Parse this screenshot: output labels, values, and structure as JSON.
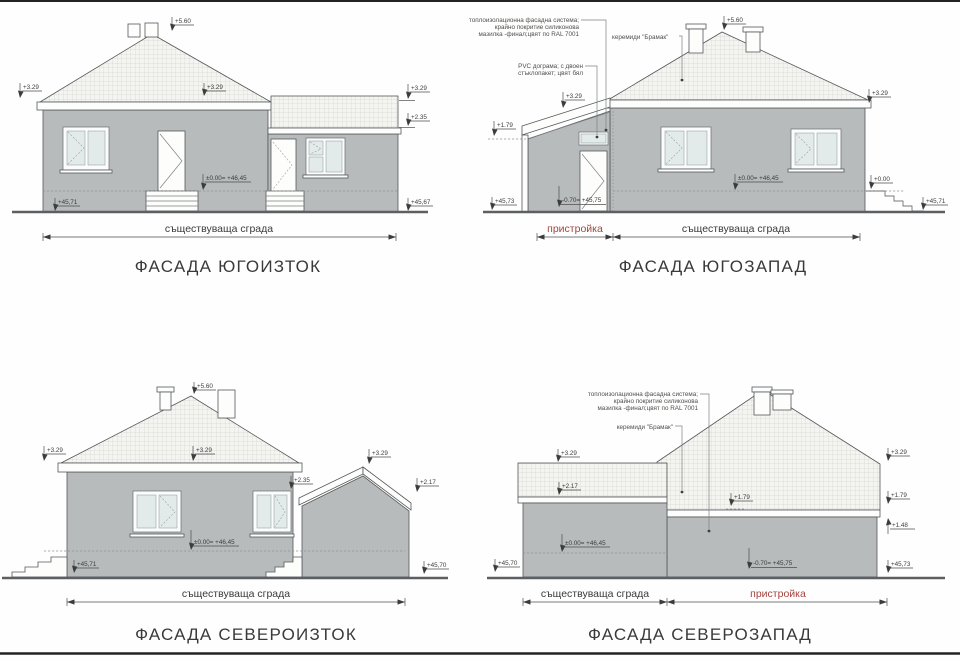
{
  "drawing": {
    "shared": {
      "existing_label": "съществуваща сграда",
      "annex_label": "пристройка",
      "insulation_note": [
        "топлоизолационна фасадна система;",
        "крайно покритие силиконова",
        "мазилка -финал;цвят по RAL 7001"
      ],
      "pvc_note": [
        "PVC дограма; с двоен",
        "стъклопакет; цвят бял"
      ],
      "tiles_note": "керемиди \"Брамак\""
    },
    "colors": {
      "wall_gray": "#b7bbbc",
      "accent_red": "#a5433c",
      "line": "#55585a",
      "roof_bg": "#f4f4f1"
    },
    "facade_se": {
      "title": "ФАСАДА ЮГОИЗТОК",
      "marks": {
        "peak": "+5.60",
        "eaves_left": "+3.29",
        "roof_mid": "+3.29",
        "eaves_right": "+3.29",
        "annex_roof": "+2.35",
        "floor": "±0.00= +46,45",
        "ground_left": "+45,71",
        "ground_right": "+45,67"
      }
    },
    "facade_sw": {
      "title": "ФАСАДА ЮГОЗАПАД",
      "marks": {
        "peak": "+5.60",
        "annex_top": "+3.29",
        "eaves_right": "+3.29",
        "annex_low": "+1.79",
        "floor": "±0.00= +46,45",
        "floor_right": "+0.00",
        "door": "-0.70= +45,75",
        "ground_left": "+45,73",
        "ground_right": "+45,71"
      }
    },
    "facade_ne": {
      "title": "ФАСАДА СЕВЕРОИЗТОК",
      "marks": {
        "peak": "+5.60",
        "eaves_left": "+3.29",
        "roof_mid": "+3.29",
        "annex_peak": "+3.29",
        "annex_left": "+2.35",
        "annex_right": "+2.17",
        "floor": "±0.00= +46,45",
        "ground_left": "+45,71",
        "ground_right": "+45,70"
      }
    },
    "facade_nw": {
      "title": "ФАСАДА СЕВЕРОЗАПАД",
      "marks": {
        "parapet_top": "+3.29",
        "parapet_low": "+2.17",
        "roof_right": "+3.29",
        "eaves_right": "+1.79",
        "eaves_mid": "+1.79",
        "wall_top": "+1.48",
        "floor": "±0.00= +46,45",
        "door": "-0.70= +45,75",
        "ground_left": "+45,70",
        "ground_right": "+45,73"
      }
    }
  }
}
